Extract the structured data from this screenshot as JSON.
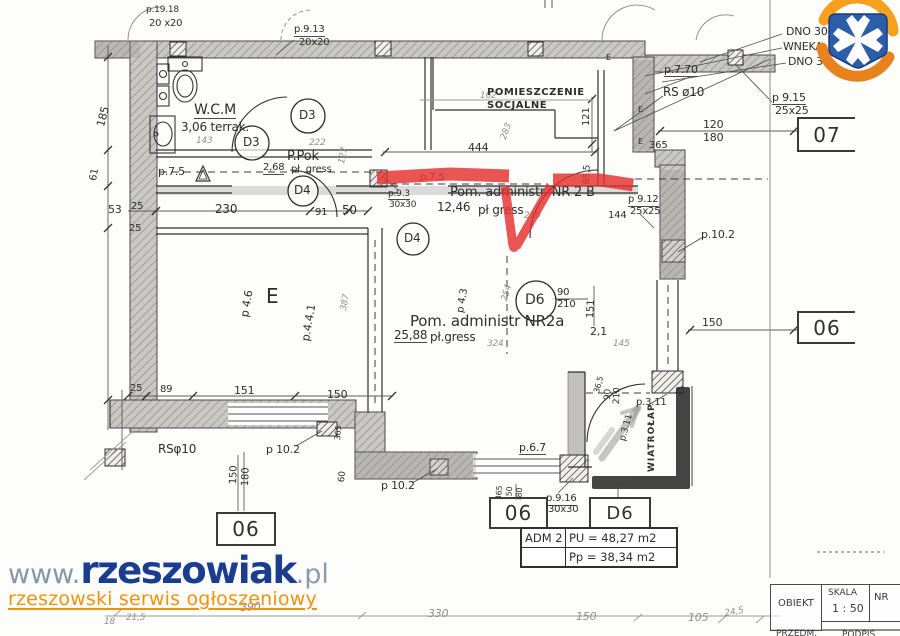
{
  "watermark": {
    "www": "www.",
    "brand": "rzeszowiak",
    "tld": ".pl",
    "tagline": "rzeszowski serwis ogłoszeniowy"
  },
  "rooms": {
    "socjalne_1": "POMIESZCZENIE",
    "socjalne_2": "SOCJALNE",
    "wcm": "W.C.M",
    "wcm_area": "3,06 terrak.",
    "ppok": "P.Pok",
    "ppok_area": "2,68",
    "ppok_floor": "pł. gress",
    "nr2b": "Pom. administr. NR 2 B",
    "nr2b_area": "12,46",
    "nr2b_floor": "pł gress",
    "nr2a": "Pom. administr NR2a",
    "nr2a_area": "25,88",
    "nr2a_floor": "pł.gress",
    "wiatrolap": "WIATROŁAP",
    "e_room": "E"
  },
  "doors": {
    "d3": "D3",
    "d4": "D4",
    "d6": "D6",
    "d6_w": "90",
    "d6_h": "210"
  },
  "ref_boxes": {
    "b07": "07",
    "b06_right": "06",
    "b06_left": "06",
    "b06_mid": "06",
    "bd6": "D6"
  },
  "area_table": {
    "id": "ADM 2",
    "pu": "PU = 48,27 m2",
    "pp": "Pp = 38,34 m2"
  },
  "title_block": {
    "obiekt": "OBIEKT",
    "skala": "SKALA",
    "scale": "1 : 50",
    "nr": "NR",
    "przedm": "PRZEDM.",
    "podpis": "PODPIS"
  },
  "dims": {
    "p1918": "p.19.18",
    "s20x20a": "20 x20",
    "p913": "p.9.13",
    "s20x20b": "20x20",
    "dno30a": "DNO 30",
    "wneka": "WNEKA",
    "dno30b": "DNO 30",
    "p770": "p.7.70",
    "rs10_top": "RS ø10",
    "p915": "p 9.15",
    "s25a": "25x25",
    "n120": "120",
    "n180": "180",
    "n365t": "365",
    "n121": "121",
    "n162": "162",
    "n283": "283",
    "n444": "444",
    "n655": "65,5",
    "p75a": "p.7.5",
    "p75b": "p.7.5",
    "n143": "143",
    "n222": "222",
    "n127": "127",
    "p93": "p.9.3",
    "s30a": "30x30",
    "n210p": "210",
    "n144": "144",
    "p912": "p 9.12",
    "s25b": "25x25",
    "p102r": "p.10.2",
    "n150r": "150",
    "n151": "151",
    "p43": "p 4.3",
    "n254": "254",
    "n324": "324",
    "n21": "2,1",
    "n145": "145",
    "p46": "p 4.6",
    "p441": "p.4.4.1",
    "n387": "387",
    "n230": "230",
    "n91": "91",
    "n50": "50",
    "n53": "53",
    "n25a": "25",
    "n25b": "25",
    "n185": "185",
    "n61": "61",
    "n25c": "25",
    "n89": "89",
    "n151b": "151",
    "n150b": "150",
    "rs10_bot": "RSφ10",
    "p102l": "p 10.2",
    "n150v": "150",
    "n180v": "180",
    "n365s": "365",
    "n60": "60",
    "p67": "p.6.7",
    "p102m": "p 10.2",
    "t365": "365",
    "t150": "150",
    "t180": "180",
    "p916": "p.9.16",
    "s30b": "30x30",
    "p311a": "p.3.11",
    "p311b": "p.3.11",
    "w90": "90",
    "w210": "210",
    "w365": "36,5",
    "e1": "E",
    "e2": "E",
    "e3": "E",
    "g390": "390",
    "g330": "330",
    "g150": "150",
    "g105": "105",
    "g245": "24,5",
    "g18": "18",
    "g215": "21,5"
  }
}
